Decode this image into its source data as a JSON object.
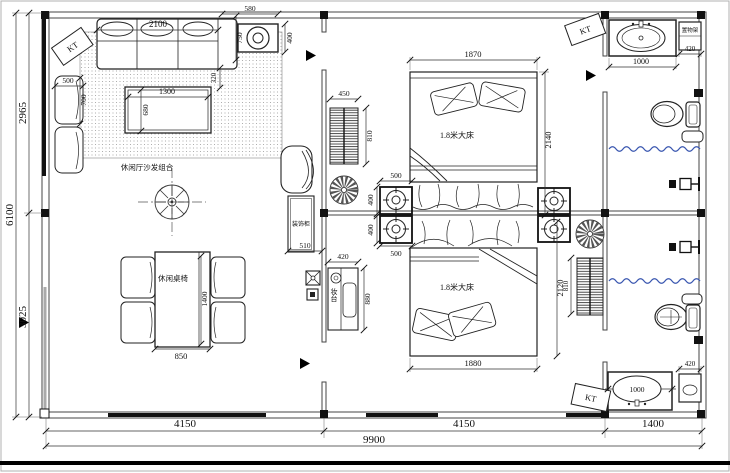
{
  "plan": {
    "ac_unit_label": "KT",
    "overall_dims": {
      "left_total": "6100",
      "left_upper": "2965",
      "left_lower": "3025",
      "bottom_left": "4150",
      "bottom_middle": "4150",
      "bottom_right": "1400",
      "bottom_total": "9900"
    },
    "living": {
      "sofa_group_label": "休闲厅沙发组合",
      "table_chairs_label": "休闲桌椅",
      "dims": {
        "corner_unit_width": "580",
        "corner_unit_depth": "400",
        "sofa_length": "2100",
        "sofa_depth": "750",
        "sofa_gap": "320",
        "armchair_width": "500",
        "armchair_depth": "700",
        "coffee_table_length": "1300",
        "coffee_table_width": "680",
        "dining_table_length": "1400",
        "dining_table_width": "850"
      }
    },
    "hall": {
      "cabinet_label": "装饰柜",
      "dresser_label": "妆台",
      "dims": {
        "cabinet_width": "510",
        "dresser_width": "420",
        "dresser_depth": "880"
      }
    },
    "bedroom_top": {
      "bed_label": "1.8米大床",
      "dims": {
        "bed_width": "1870",
        "bed_length": "2140",
        "radiator_width": "450",
        "radiator_height": "810",
        "nightstand_width": "500",
        "nightstand_depth": "400"
      }
    },
    "bedroom_bottom": {
      "bed_label": "1.8米大床",
      "dims": {
        "bed_width": "1880",
        "bed_length": "2120",
        "radiator_height": "810",
        "nightstand_width": "500",
        "nightstand_depth": "400"
      }
    },
    "bath_top": {
      "shelf_label": "置物架",
      "dims": {
        "vanity_width": "1000",
        "shelf_width": "420"
      }
    },
    "bath_bottom": {
      "dims": {
        "vanity_width": "1000",
        "shelf_width": "420"
      }
    },
    "colors": {
      "curtain_blue": "#3a57b0"
    }
  }
}
